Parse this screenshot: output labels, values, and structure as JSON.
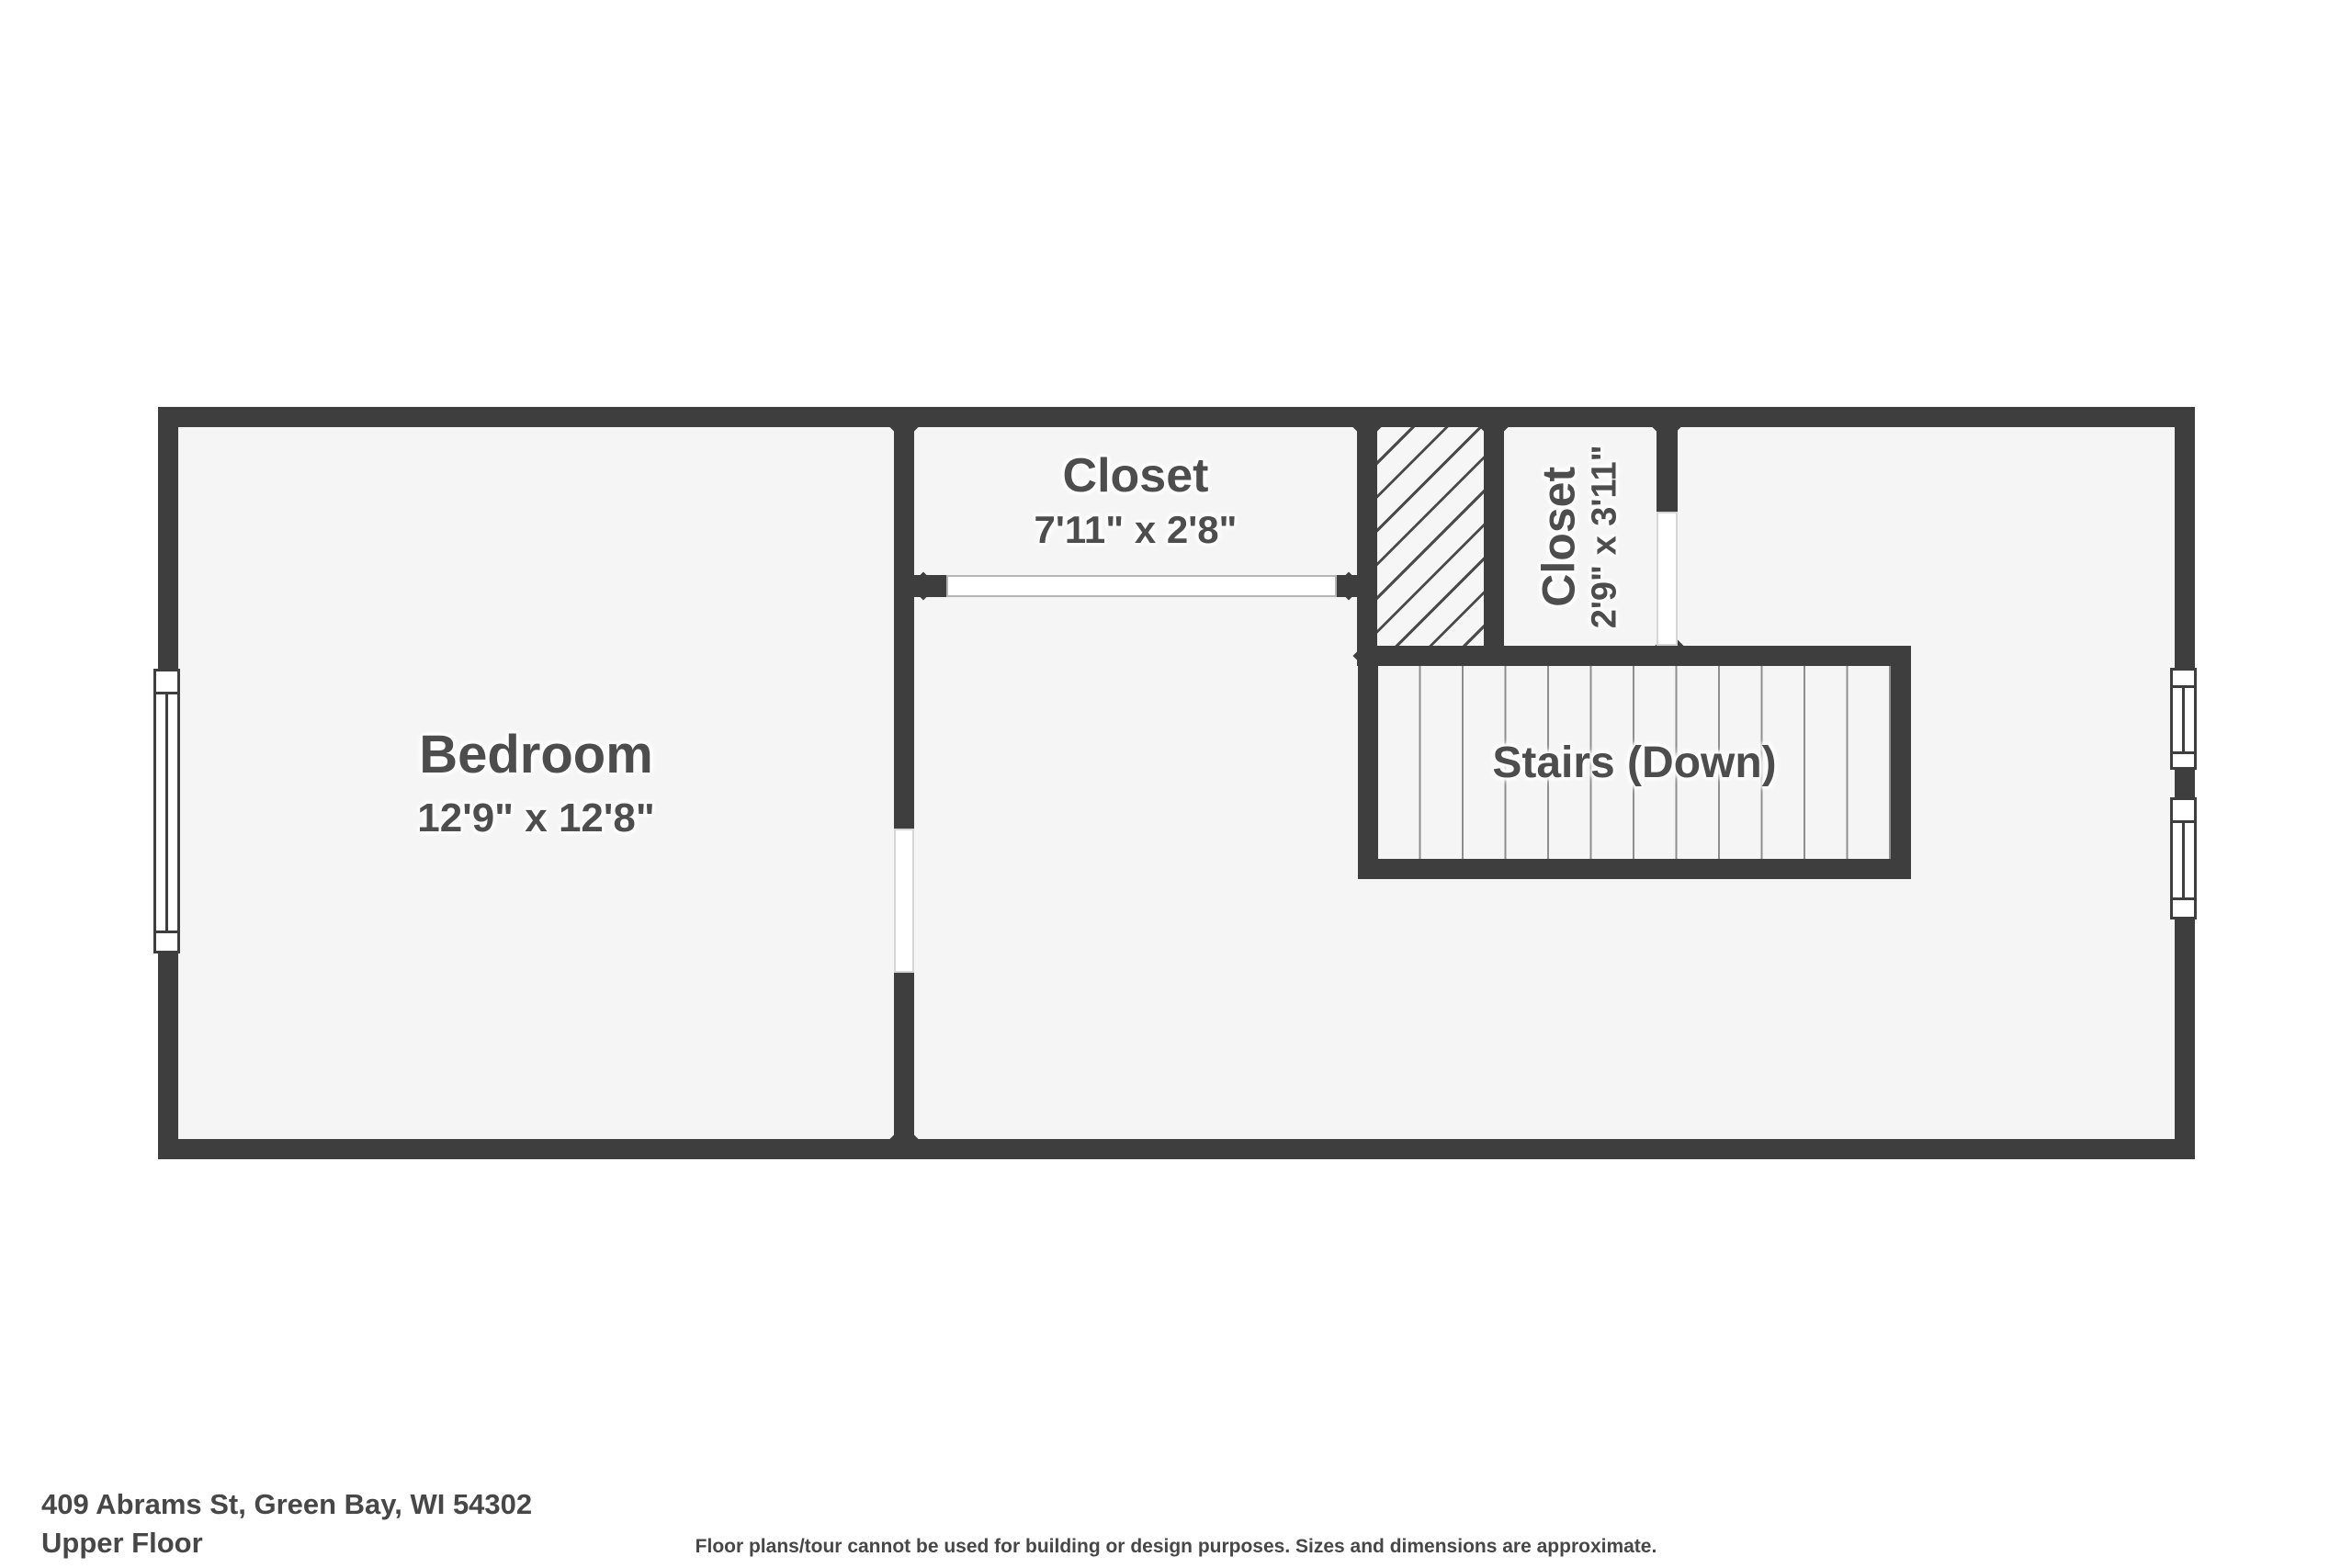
{
  "palette": {
    "wall": "#3e3e3e",
    "floor": "#f5f5f5",
    "hatch_line": "#4a4a4a",
    "tread_line": "#8e8e8e",
    "label_text": "#4d4d4d",
    "footer_text": "#474747"
  },
  "rooms": {
    "bedroom": {
      "name": "Bedroom",
      "dims": "12'9\" x 12'8\""
    },
    "closet_top": {
      "name": "Closet",
      "dims": "7'11\" x 2'8\""
    },
    "closet_side": {
      "name": "Closet",
      "dims": "2'9\" x 3'11\""
    },
    "stairs": {
      "name": "Stairs (Down)"
    }
  },
  "footer": {
    "address": "409 Abrams St, Green Bay, WI 54302",
    "floor": "Upper Floor",
    "disclaimer": "Floor plans/tour cannot be used for building or design purposes. Sizes and dimensions are approximate."
  }
}
